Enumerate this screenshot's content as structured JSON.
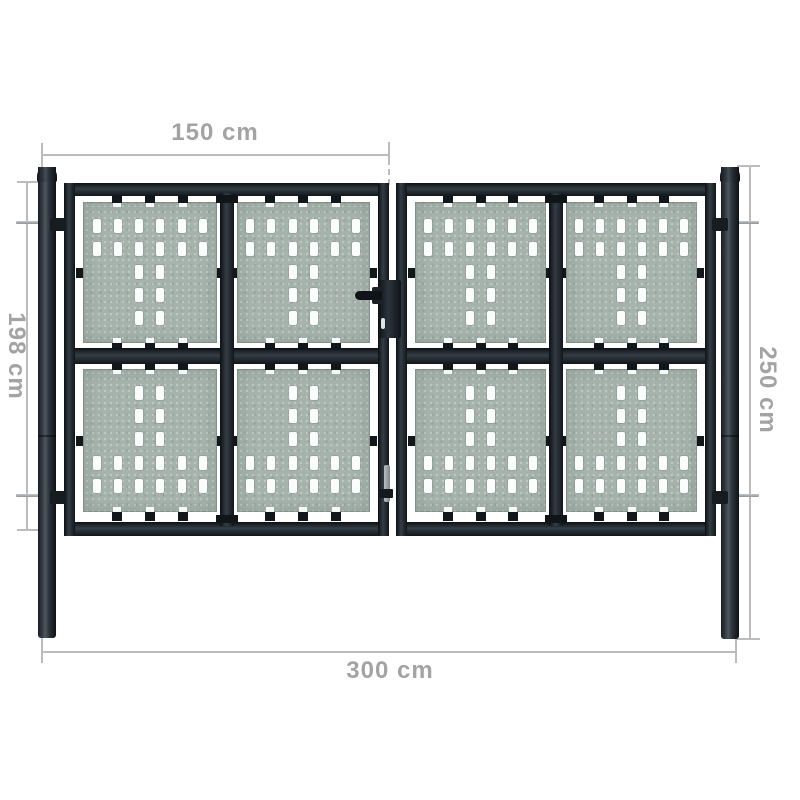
{
  "diagram": {
    "type": "product-dimension-diagram",
    "product": "Black double-door garden fence gate with perforated panels and two round posts",
    "dimensions": {
      "top": {
        "label": "150 cm",
        "measures": "single door leaf width"
      },
      "left": {
        "label": "198 cm",
        "measures": "door leaf height"
      },
      "right": {
        "label": "250 cm",
        "measures": "post height"
      },
      "bottom": {
        "label": "300 cm",
        "measures": "total gate width"
      }
    }
  },
  "gate": {
    "doors": 2,
    "panels_per_door": 4,
    "posts": 2,
    "hole_pattern": {
      "top": [
        [
          1,
          1,
          1,
          1,
          1,
          1
        ],
        [
          1,
          1,
          1,
          1,
          1,
          1
        ],
        [
          0,
          0,
          1,
          1,
          0,
          0
        ],
        [
          0,
          0,
          1,
          1,
          0,
          0
        ],
        [
          0,
          0,
          1,
          1,
          0,
          0
        ]
      ],
      "bottom": [
        [
          0,
          0,
          1,
          1,
          0,
          0
        ],
        [
          0,
          0,
          1,
          1,
          0,
          0
        ],
        [
          0,
          0,
          1,
          1,
          0,
          0
        ],
        [
          1,
          1,
          1,
          1,
          1,
          1
        ],
        [
          1,
          1,
          1,
          1,
          1,
          1
        ]
      ]
    }
  },
  "colors": {
    "background": "#ffffff",
    "frame": "#1b2127",
    "panel_base": "#a6b3ad",
    "hole": "#fbfdfc",
    "dim_line": "#bcbcbc",
    "dim_text": "#a3a3a3",
    "metal_pin": "#9aa1a6"
  }
}
